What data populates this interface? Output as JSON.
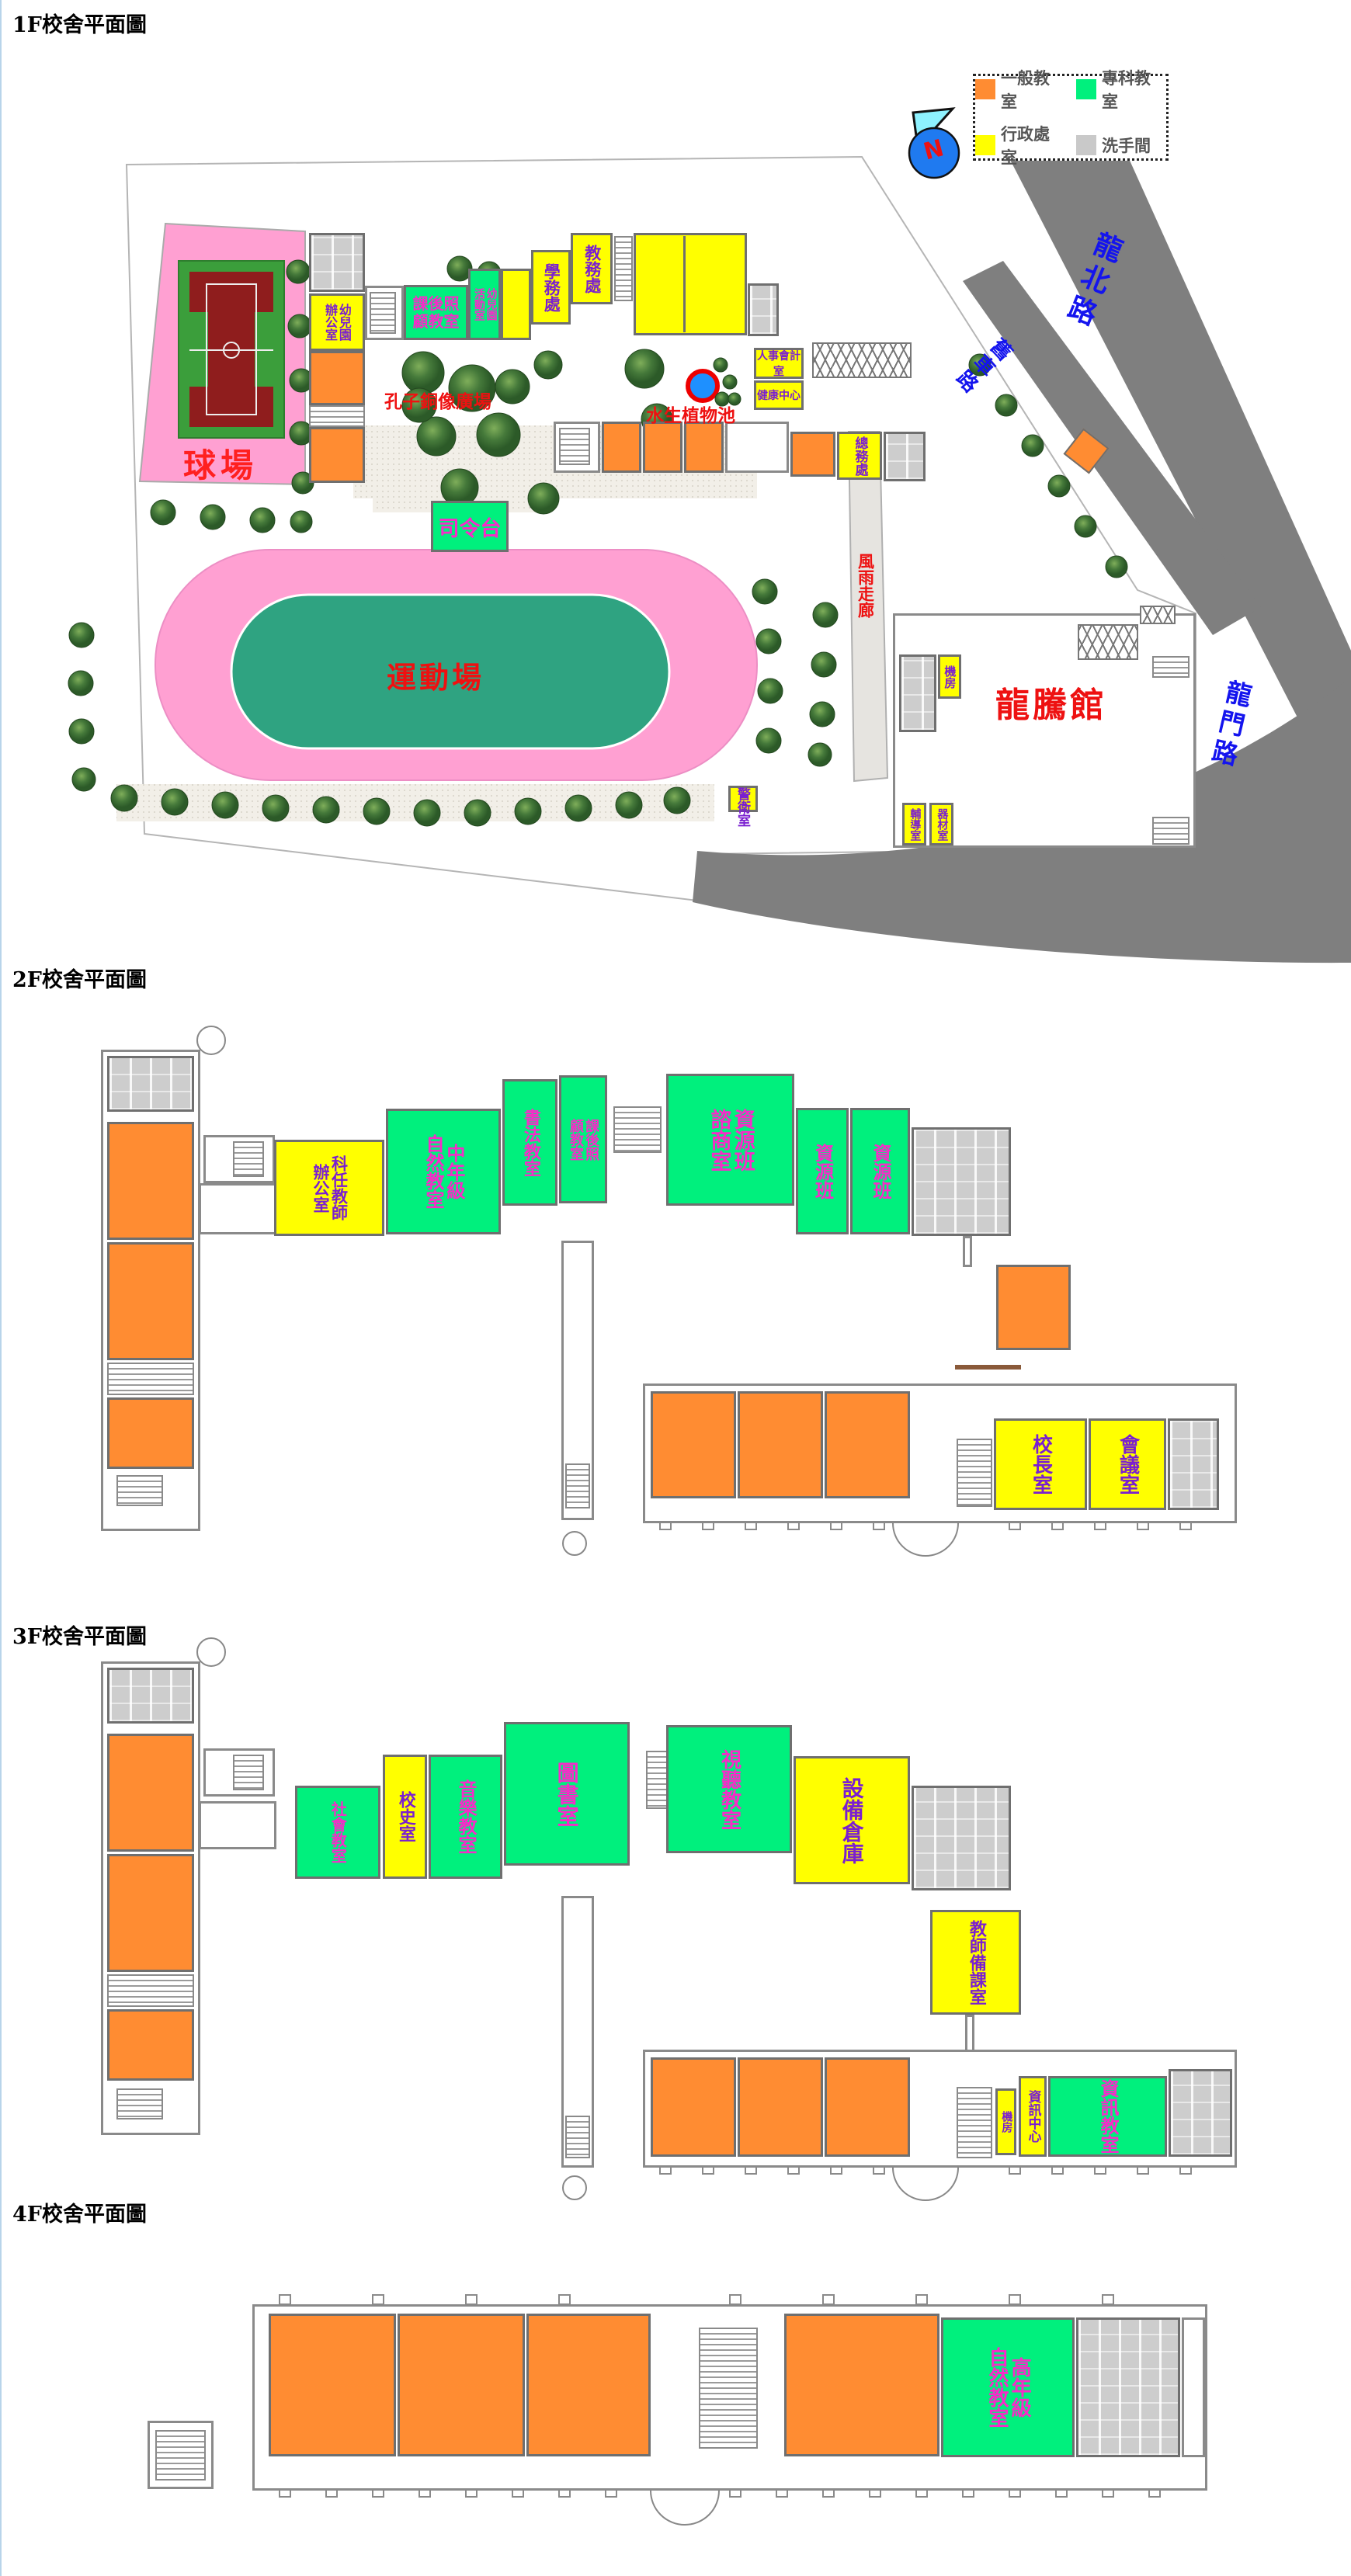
{
  "legend": {
    "items": [
      {
        "label": "一般教室",
        "color": "#ff8c32"
      },
      {
        "label": "專科教室",
        "color": "#00f07d"
      },
      {
        "label": "行政處室",
        "color": "#ffff00"
      },
      {
        "label": "洗手間",
        "color": "#c9c9c9"
      }
    ]
  },
  "compass": {
    "n": "N"
  },
  "floor1": {
    "title": "1F校舍平面圖",
    "roads": {
      "north": "龍北路",
      "old_cart": "舊車路",
      "gate": "龍門路"
    },
    "rooms": {
      "kinder_office": "幼兒園\n辦公室",
      "after_school": "課後照\n顧教室",
      "kinder_activity": "幼兒園\n活動室",
      "student_affairs": "學務處",
      "academic_affairs": "教務處",
      "personnel": "人事會計室",
      "health": "健康中心",
      "general_affairs": "總務處",
      "machine": "機房",
      "counseling": "輔導室",
      "equipment": "器材室",
      "guard": "警衛室"
    },
    "places": {
      "stage": "司令台",
      "sports_field": "運動場",
      "ball_court": "球場",
      "confucius": "孔子銅像廣場",
      "pond": "水生植物池",
      "rain_corridor": "風雨走廊",
      "gym": "龍騰館"
    }
  },
  "floor2": {
    "title": "2F校舍平面圖",
    "rooms": {
      "subject_teacher": "科任教師\n辦公室",
      "mid_science": "中年級\n自然教室",
      "calligraphy": "書法教室",
      "after_school": "課後照\n顧教室",
      "resource_counsel": "資源班\n諮商室",
      "resource_a": "資源班",
      "resource_b": "資源班",
      "principal": "校長室",
      "conference": "會議室"
    }
  },
  "floor3": {
    "title": "3F校舍平面圖",
    "rooms": {
      "social": "社會教室",
      "school_history": "校史室",
      "music": "音樂教室",
      "library": "圖書室",
      "av": "視聽教室",
      "equipment_storage": "設備倉庫",
      "teacher_prep": "教師備課室",
      "machine": "機房",
      "it_center": "資訊中心",
      "it_room": "資訊教室"
    }
  },
  "floor4": {
    "title": "4F校舍平面圖",
    "rooms": {
      "senior_science": "高年級\n自然教室"
    }
  }
}
